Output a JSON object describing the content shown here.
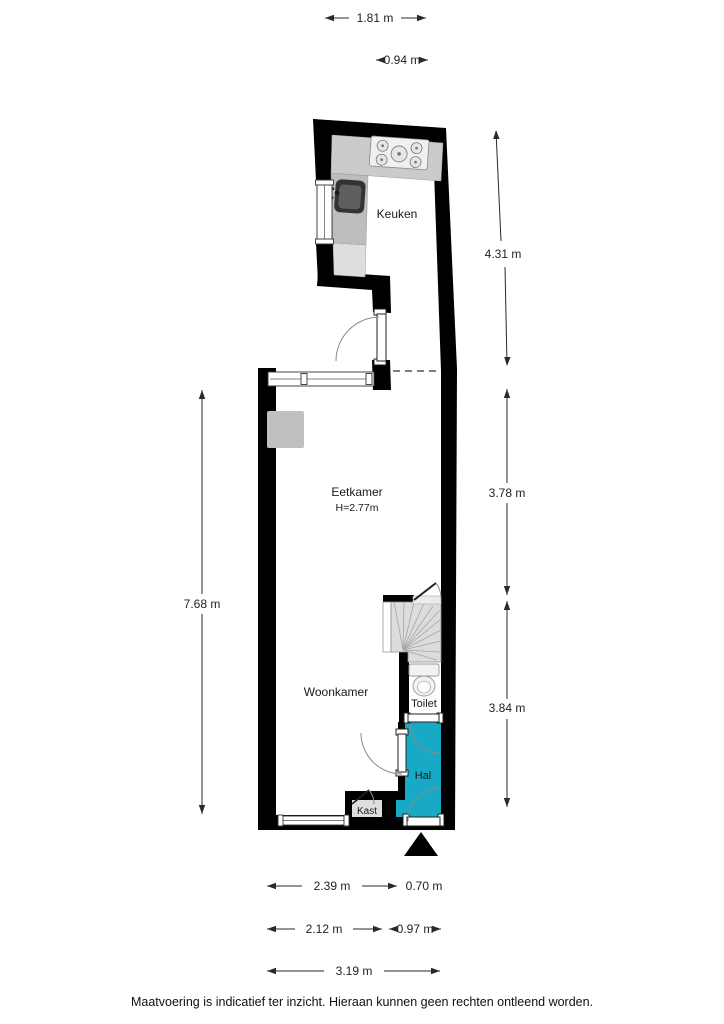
{
  "plan": {
    "rooms": {
      "keuken": {
        "label": "Keuken"
      },
      "eetkamer": {
        "label": "Eetkamer",
        "height_note": "H=2.77m"
      },
      "woonkamer": {
        "label": "Woonkamer"
      },
      "toilet": {
        "label": "Toilet"
      },
      "hal": {
        "label": "Hal"
      },
      "kast": {
        "label": "Kast"
      }
    },
    "dimensions": {
      "top_kitchen_width": "1.81 m",
      "top_upper_width": "0.94 m",
      "right_kitchen_depth": "4.31 m",
      "right_eetkamer_depth": "3.78 m",
      "right_woonkamer_depth": "3.84 m",
      "left_total_depth": "7.68 m",
      "bottom_row1_left": "2.39 m",
      "bottom_row1_right": "0.70 m",
      "bottom_row2_left": "2.12 m",
      "bottom_row2_right": "0.97 m",
      "bottom_row3": "3.19 m"
    },
    "colors": {
      "wall": "#000000",
      "hal_floor": "#18a9c4",
      "stairs_floor": "#dcdcdc",
      "counter": "#cbcbcb"
    },
    "footer": "Maatvoering is indicatief ter inzicht. Hieraan kunnen geen rechten ontleend worden."
  }
}
